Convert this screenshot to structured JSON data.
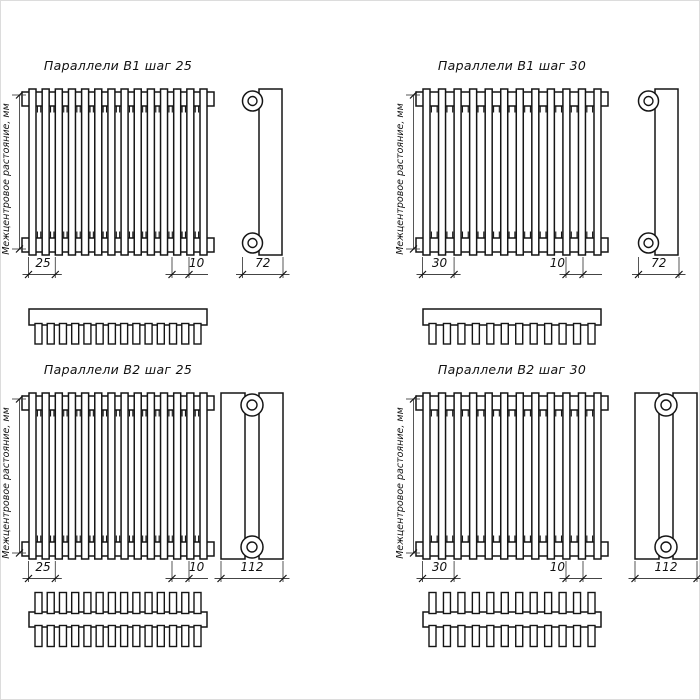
{
  "page": {
    "background": "#ffffff",
    "line_color": "#151515",
    "dim_line_color": "#444444"
  },
  "shared": {
    "left_axis_label": "Межцентровое растояние, мм"
  },
  "quadrants": [
    {
      "title": "Параллели В1 шаг 25",
      "series": "В1",
      "step": "25",
      "tube_width": "10",
      "depth": "72",
      "tube_count": 14,
      "tube_rows": 1
    },
    {
      "title": "Параллели В1 шаг 30",
      "series": "В1",
      "step": "30",
      "tube_width": "10",
      "depth": "72",
      "tube_count": 12,
      "tube_rows": 1
    },
    {
      "title": "Параллели В2 шаг 25",
      "series": "В2",
      "step": "25",
      "tube_width": "10",
      "depth": "112",
      "tube_count": 14,
      "tube_rows": 2
    },
    {
      "title": "Параллели В2 шаг 30",
      "series": "В2",
      "step": "30",
      "tube_width": "10",
      "depth": "112",
      "tube_count": 12,
      "tube_rows": 2
    }
  ]
}
